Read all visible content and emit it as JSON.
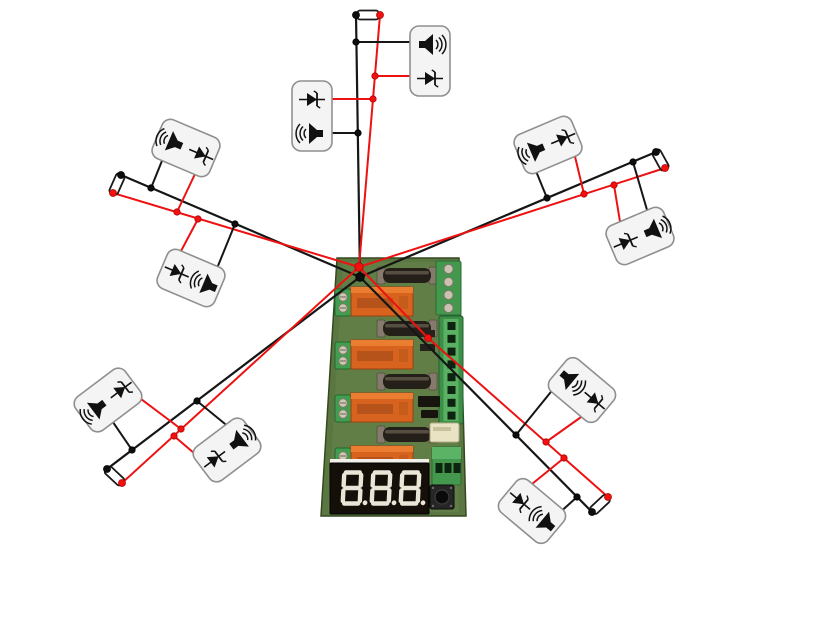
{
  "title": "relay-board-buzzer-wiring-diagram",
  "colors": {
    "background": "#ffffff",
    "wire_black": "#161616",
    "wire_red": "#ee1111",
    "dot_black": "#0e0e0e",
    "dot_red": "#f50f0f",
    "dot_red_edge": "#a80808",
    "module_fill": "#f4f4f4",
    "module_stroke": "#8f8f8f",
    "icon": "#111111",
    "fuse_fill": "#ffffff",
    "fuse_stroke": "#1a1a1a",
    "pcb_green": "#5a7742",
    "relay_orange": "#d8631e",
    "terminal_green": "#3f9e4f",
    "display_bezel": "#140f08",
    "display_segment": "#e9e6d8"
  },
  "board": {
    "name": "relay-control-board",
    "relay_count": 4,
    "fuse_holder_count": 4,
    "left_terminal_count": 4,
    "right_screw_count": 4,
    "right_header_holes": 8,
    "bottom_terminal_pins": 3,
    "has_push_button": true,
    "display": {
      "digits": "888",
      "decimal_points": 3
    }
  },
  "diagram": {
    "node_black": [
      360,
      277
    ],
    "node_red": [
      359,
      267
    ],
    "branches": [
      {
        "name": "top",
        "black_end": [
          356,
          15
        ],
        "red_end": [
          380,
          15
        ],
        "fuse": {
          "cx": 368,
          "cy": 15,
          "angle": 0
        },
        "taps": [
          {
            "w": "black",
            "at": [
              356,
              42
            ],
            "to": [
              412,
              42
            ]
          },
          {
            "w": "red",
            "at": [
              375,
              76
            ],
            "to": [
              412,
              76
            ]
          },
          {
            "w": "red",
            "at": [
              373,
              99
            ],
            "to": [
              332,
              99
            ]
          },
          {
            "w": "black",
            "at": [
              358,
              133
            ],
            "to": [
              332,
              133
            ]
          }
        ],
        "modules": [
          {
            "name": "top-right",
            "cx": 430,
            "cy": 61,
            "rot": 0,
            "orient": "portrait",
            "items": [
              "speaker",
              "diode"
            ],
            "speaker_face": "right"
          },
          {
            "name": "top-left",
            "cx": 312,
            "cy": 116,
            "rot": 0,
            "orient": "portrait",
            "items": [
              "diode",
              "speaker"
            ],
            "speaker_face": "left"
          }
        ]
      },
      {
        "name": "upper-left",
        "black_end": [
          121,
          175
        ],
        "red_end": [
          113,
          193
        ],
        "fuse": {
          "cx": 117,
          "cy": 184,
          "angle": 114
        },
        "taps": [
          {
            "w": "black",
            "at": [
              151,
              188
            ],
            "to": [
              170,
              141
            ]
          },
          {
            "w": "red",
            "at": [
              177,
              212
            ],
            "to": [
              204,
              155
            ]
          },
          {
            "w": "red",
            "at": [
              198,
              219
            ],
            "to": [
              172,
              268
            ]
          },
          {
            "w": "black",
            "at": [
              235,
              224
            ],
            "to": [
              209,
              288
            ]
          }
        ],
        "modules": [
          {
            "name": "upper-left-outer",
            "cx": 186,
            "cy": 148,
            "rot": 23,
            "orient": "landscape",
            "items": [
              "speaker",
              "diode"
            ],
            "speaker_face": "left"
          },
          {
            "name": "upper-left-inner",
            "cx": 191,
            "cy": 278,
            "rot": 23,
            "orient": "landscape",
            "items": [
              "diode",
              "speaker"
            ],
            "speaker_face": "left"
          }
        ]
      },
      {
        "name": "lower-left",
        "black_end": [
          107,
          469
        ],
        "red_end": [
          122,
          483
        ],
        "fuse": {
          "cx": 114.5,
          "cy": 476,
          "angle": 43
        },
        "taps": [
          {
            "w": "black",
            "at": [
              132,
              450
            ],
            "to": [
              104,
              409
            ]
          },
          {
            "w": "red",
            "at": [
              181,
              429
            ],
            "to": [
              125,
              387
            ]
          },
          {
            "w": "red",
            "at": [
              174,
              436
            ],
            "to": [
              215,
              471
            ]
          },
          {
            "w": "black",
            "at": [
              197,
              401
            ],
            "to": [
              241,
              437
            ]
          }
        ],
        "modules": [
          {
            "name": "lower-left-outer",
            "cx": 108,
            "cy": 400,
            "rot": -37,
            "orient": "landscape",
            "items": [
              "speaker",
              "diode"
            ],
            "speaker_face": "left"
          },
          {
            "name": "lower-left-inner",
            "cx": 227,
            "cy": 450,
            "rot": -37,
            "orient": "landscape",
            "items": [
              "diode",
              "speaker"
            ],
            "speaker_face": "right"
          }
        ]
      },
      {
        "name": "upper-right",
        "black_end": [
          656,
          152
        ],
        "red_end": [
          665,
          168
        ],
        "fuse": {
          "cx": 660.5,
          "cy": 160,
          "angle": 61
        },
        "taps": [
          {
            "w": "black",
            "at": [
              547,
              198
            ],
            "to": [
              529,
              154
            ]
          },
          {
            "w": "red",
            "at": [
              584,
              194
            ],
            "to": [
              572,
              144
            ]
          },
          {
            "w": "red",
            "at": [
              614,
              185
            ],
            "to": [
              624,
              246
            ]
          },
          {
            "w": "black",
            "at": [
              633,
              162
            ],
            "to": [
              652,
              227
            ]
          }
        ],
        "modules": [
          {
            "name": "upper-right-outer",
            "cx": 548,
            "cy": 145,
            "rot": -23,
            "orient": "landscape",
            "items": [
              "speaker",
              "diode"
            ],
            "speaker_face": "left"
          },
          {
            "name": "upper-right-inner",
            "cx": 640,
            "cy": 236,
            "rot": -23,
            "orient": "landscape",
            "items": [
              "diode",
              "speaker"
            ],
            "speaker_face": "right"
          }
        ]
      },
      {
        "name": "lower-right",
        "black_end": [
          592,
          512
        ],
        "red_end": [
          608,
          497
        ],
        "red_via": [
          [
            428,
            338
          ]
        ],
        "fuse": {
          "cx": 600,
          "cy": 504.5,
          "angle": -43
        },
        "taps": [
          {
            "w": "black",
            "at": [
              516,
              435
            ],
            "to": [
              563,
              377
            ]
          },
          {
            "w": "red",
            "at": [
              546,
              442
            ],
            "to": [
              598,
              405
            ]
          },
          {
            "w": "red",
            "at": [
              564,
              458
            ],
            "to": [
              516,
              497
            ]
          },
          {
            "w": "black",
            "at": [
              577,
              497
            ],
            "to": [
              547,
              524
            ]
          }
        ],
        "modules": [
          {
            "name": "lower-right-outer",
            "cx": 582,
            "cy": 390,
            "rot": 40,
            "orient": "landscape",
            "items": [
              "speaker",
              "diode"
            ],
            "speaker_face": "right"
          },
          {
            "name": "lower-right-inner",
            "cx": 532,
            "cy": 511,
            "rot": 40,
            "orient": "landscape",
            "items": [
              "diode",
              "speaker"
            ],
            "speaker_face": "left"
          }
        ]
      }
    ]
  }
}
